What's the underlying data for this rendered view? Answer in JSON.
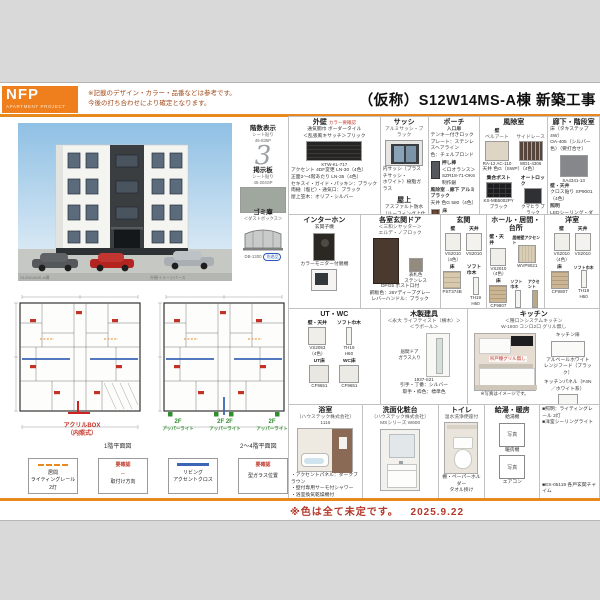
{
  "header": {
    "logo_title": "NFP",
    "logo_subtitle": "APARTMENT  PROJECT",
    "disclaimer_line1": "※記載のデザイン・カラー・品番などは参考です。",
    "disclaimer_line2": "今後の打ち合わせにより確定となります。",
    "title": "（仮称）S12W14MS-A棟 新築工事"
  },
  "render": {
    "caption_left": "S12W14MS-A棟",
    "caption_right": "外観イメージパース",
    "floors": {
      "title": "階数表示",
      "sub1": "シート貼り",
      "sub2": "45-835P",
      "numeral": "3"
    },
    "board": {
      "title": "掲示板",
      "sub1": "シート貼り",
      "sub2": "45-204SP"
    },
    "dustbox": {
      "title": "ゴミ庫",
      "sub": "＜ダストボックス＞",
      "code": "DB-1300",
      "tag": "別途品"
    }
  },
  "plans": {
    "plan1": {
      "caption": "1階平面図",
      "annotation1": "アクリルBOX",
      "annotation2": "（内照式）"
    },
    "plan2": {
      "caption": "2〜4階平面図",
      "f1": "2F",
      "u1": "アッパーライト",
      "f2": "2F",
      "f3": "2F",
      "u2": "アッパーライト",
      "f4": "2F",
      "u3": "アッパーライト"
    },
    "legend": [
      {
        "l1": "居間",
        "l2": "ライティングレール",
        "l3": "2灯"
      },
      {
        "l1": "要確認",
        "sym": "⇔",
        "l2": "取付け方向"
      },
      {
        "l1": "リビング",
        "l2": "アクセントクロス"
      },
      {
        "l1": "要確認",
        "l2": "型ガラス位置"
      }
    ]
  },
  "specs": {
    "gaiheki": {
      "title": "外壁",
      "note": "カラー要確認",
      "l1": "通気胴巾 ボーダータイル",
      "l2": "＜乱張風キサッチ＞ブリック",
      "code": "KTW-KL-717",
      "l3": "アクセント 4DF変更 LN-30（4色）",
      "l4": "正面2〜4階あたり LN-35（4色）",
      "l5": "セキスイ・ガイド・パッキン：ブラック",
      "l6": "雨樋（塩ビ）・通気口：ブラック",
      "l7": "屋上笠木：オリブ・シルバー"
    },
    "sash": {
      "title": "サッシ",
      "sub": "アルミサッシ・ブラック",
      "l1": "内サッシ（プラスチサッシ・",
      "l2": "ホワイト）樹脂ガラス"
    },
    "okujo": {
      "title": "屋上",
      "l1": "アスファルト防水",
      "l2": "（ルーフィング上仕上・断熱）",
      "l3": "シルバー仕上げ"
    },
    "porch": {
      "title": "ポーチ",
      "sub": "入口扉",
      "l1": "テンキー付きロック",
      "l2": "プレート：ステンレスヘアライン",
      "l3": "色：チェルブロンド",
      "oshibo": "押し棒",
      "l4": "＜ロオランス＞",
      "l5": "SZR18-71-OK6 制作銀",
      "kaze": "風除室→廊下 アルミブラック",
      "tenjo": "天井 色G 580（4色）",
      "yuka": "床",
      "l6": "一般玄関タイル 300角タイル",
      "l7": "タイルヘッド MRT-5 黒目地"
    },
    "fujo": {
      "title": "風除室",
      "kabe": "壁",
      "kabe_a": "ベルアート",
      "kabe_b": "サイドレース",
      "code_a": "RA-12 AC-110",
      "code_b": "WD1-4306",
      "tenjo": "天井 色G（SWP）（4色）",
      "post": "集合ポスト",
      "lock": "オートロック",
      "post_code": "KS-MB5002PY ブラック",
      "lock_code": "クマヒラ ブラック",
      "bottom": "宅配BOX ブラック W-4-2-LH"
    },
    "rouka": {
      "title": "廊下・階段室",
      "yuka1": "床（タキステップ4W）",
      "yuka2": "OA-405（シルバー色）（要打合せ）",
      "code": "SA4341-13",
      "kabe": "壁・天井",
      "kabe2": "クロス貼り SP9001（4色）",
      "shomei": "照明",
      "s1": "LEDシーリング・ダウンライト",
      "s2": "ハンドレール：No.17 ホワイトグレー",
      "s3": "吹付け：No.4 ブラック"
    },
    "inter": {
      "title": "インターホン",
      "l1": "玄関子機",
      "l2": "カラーモニター付親機"
    },
    "door": {
      "title": "各室玄関ドア",
      "sub1": "＜三和シヤッター＞",
      "sub2": "エルデ・ノブロック",
      "note1": "表札色",
      "note2": "ステンレス",
      "l1": "DPG5 ポスト口付",
      "l2": "鋼板色：26Yディープグレー",
      "l3": "レバーハンドル：ブラック"
    },
    "genkan": {
      "title": "玄関",
      "kabe": "壁",
      "tenjo": "天井",
      "kabe_code": "VS2010",
      "tenjo_code": "VS2010",
      "note": "（4色）",
      "yuka": "床",
      "habaki": "ソフト巾木",
      "yuka_code": "PST374B",
      "habaki_code": "TH19",
      "h": "H60"
    },
    "hall": {
      "title": "ホール・居間・台所",
      "kabe": "壁・天井",
      "accent": "居間壁アクセント",
      "kabe_code": "VS2010",
      "accent_code": "WVP9021",
      "note": "（4色）",
      "yuka": "床",
      "habaki": "ソフト巾木",
      "ac2": "アクセント",
      "yuka_code": "CF9807",
      "habaki_code": "TH19",
      "h": "H60",
      "ac2_code": "9G"
    },
    "yoshitsu": {
      "title": "洋室",
      "kabe": "壁",
      "tenjo": "天井",
      "kabe_code": "VS2010",
      "tenjo_code": "VS2010",
      "note": "（4色）",
      "yuka": "床",
      "habaki": "ソフト巾木",
      "yuka_code": "CF9807",
      "habaki_code": "TH19",
      "h": "H60"
    },
    "utwc": {
      "title": "UT・WC",
      "kabe": "壁・天井",
      "habaki": "ソフト巾木",
      "kabe_code": "VS2053",
      "habaki_code": "TH19",
      "h": "H60",
      "ut": "UT床",
      "wc": "WC床",
      "ut_code": "CF9651",
      "wc_code": "CF9651",
      "note": "（4色）"
    },
    "tategu": {
      "title": "木製建具",
      "sub1": "＜永大 ライフテイスト（横木）＞",
      "sub2": "＜ラポール＞",
      "note1": "居間ドア",
      "note2": "ガラス入り",
      "code": "1937-S21",
      "l1": "引手・丁番：シルバー",
      "l2": "取手・枠色：標準色"
    },
    "kitchen": {
      "title": "キッチン",
      "sub1": "＜種口＞システムキッチン",
      "sub2": "W-1600 コンロ2口 グリル無し",
      "red_note": "吊戸棚グリル無し",
      "caption": "※写真はイメージです。",
      "door": "キッチン扉",
      "door_color": "アルベールホワイト",
      "hood": "レンジフード（ブラック）",
      "panel": "キッチンパネル（F4N／ホワイト系）"
    },
    "bath": {
      "title": "浴室",
      "sub1": "（ハウステック株式会社）",
      "sub2": "1116",
      "l1": "・アクセントパネル：ダークブラウン",
      "l2": "・壁付専用サーモ付シャワー",
      "l3": "・浴室換気乾燥機付"
    },
    "senmen": {
      "title": "洗面化粧台",
      "sub1": "（ハウステック株式会社）",
      "sub2": "MSシリーズ W600"
    },
    "toilet": {
      "title": "トイレ",
      "sub": "温水洗浄便座付",
      "l1": "棚・ペーパーホルダー",
      "l2": "タオル掛け"
    },
    "kyuto": {
      "title": "給湯・暖房",
      "a": "給湯機",
      "photo": "写真",
      "b": "暖房機",
      "photo2": "写真",
      "c": "エアコン"
    },
    "notes": {
      "l1": "■照明：ライティングレール 2灯",
      "l2": "■洋室シーリングライト",
      "l3": "■ES-05119 各戸玄関チャイム"
    }
  },
  "footer": {
    "note": "※色は全て未定です。",
    "date": "2025.9.22"
  }
}
